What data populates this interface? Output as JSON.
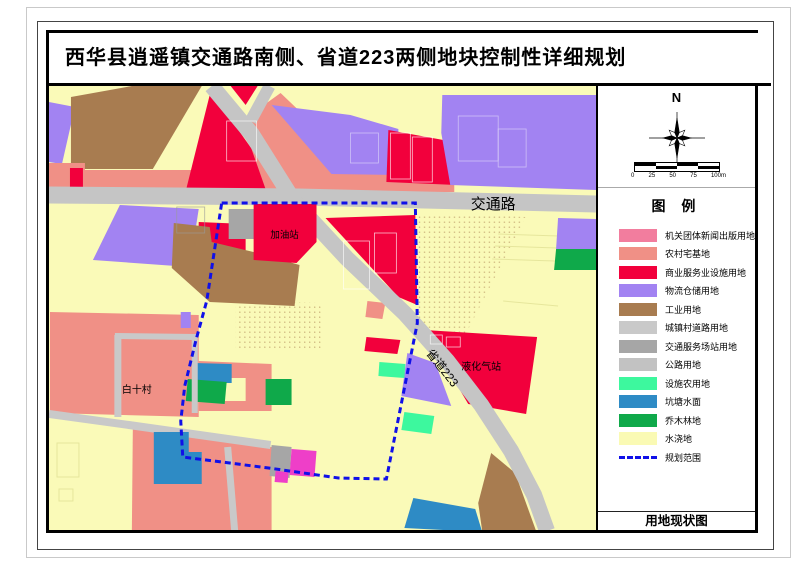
{
  "title": "西华县逍遥镇交通路南侧、省道223两侧地块控制性详细规划",
  "map": {
    "labels": {
      "road_main": "交通路",
      "road_provincial": "省道223",
      "gas_station": "加油站",
      "lpg_station": "液化气站",
      "village": "白十村"
    },
    "boundary_color": "#1010E8"
  },
  "compass": {
    "north": "N"
  },
  "scalebar": {
    "ticks": [
      "0",
      "25",
      "50",
      "75",
      "100m"
    ]
  },
  "legend": {
    "title": "图  例",
    "items": [
      {
        "label": "机关团体新闻出版用地",
        "color": "#F27D9E",
        "type": "fill"
      },
      {
        "label": "农村宅基地",
        "color": "#F09086",
        "type": "fill"
      },
      {
        "label": "商业服务业设施用地",
        "color": "#F2003C",
        "type": "fill"
      },
      {
        "label": "物流仓储用地",
        "color": "#A283F2",
        "type": "fill"
      },
      {
        "label": "工业用地",
        "color": "#A87C50",
        "type": "fill"
      },
      {
        "label": "城镇村道路用地",
        "color": "#C9C9C9",
        "type": "fill"
      },
      {
        "label": "交通服务场站用地",
        "color": "#A6A6A6",
        "type": "fill"
      },
      {
        "label": "公路用地",
        "color": "#C2C2C2",
        "type": "fill"
      },
      {
        "label": "设施农用地",
        "color": "#3DF89E",
        "type": "fill"
      },
      {
        "label": "坑塘水面",
        "color": "#2E8BC5",
        "type": "fill"
      },
      {
        "label": "乔木林地",
        "color": "#0FA94A",
        "type": "fill"
      },
      {
        "label": "水浇地",
        "color": "#FAFAB4",
        "type": "fill"
      },
      {
        "label": "规划范围",
        "color": "#1010E8",
        "type": "dashed"
      }
    ],
    "footer": "用地现状图"
  }
}
